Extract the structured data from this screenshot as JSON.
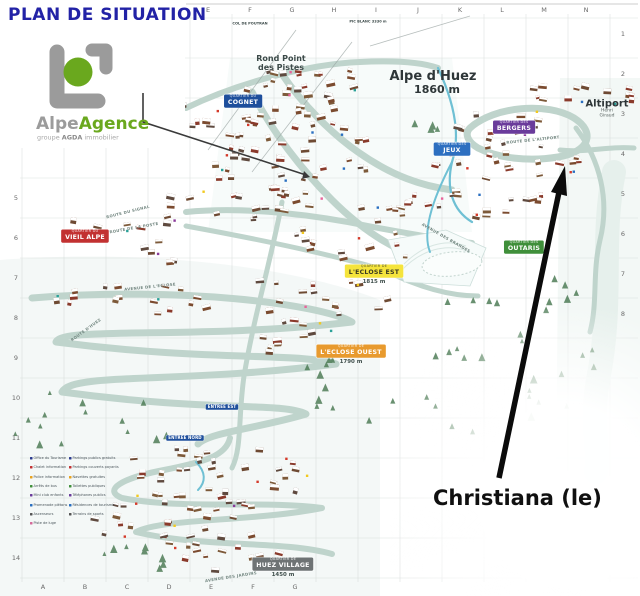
{
  "page": {
    "title": "PLAN DE SITUATION"
  },
  "logo": {
    "name_grey": "Alpe",
    "name_green": "Agence",
    "sub_prefix": "groupe",
    "sub_bold": "AGDA",
    "sub_suffix": "immobilier",
    "green": "#6aa81e",
    "grey": "#9b9b9b"
  },
  "callout": {
    "label": "Christiana (le)"
  },
  "map": {
    "summit_labels": [
      {
        "id": "rond-point-des-pistes",
        "text": "Rond Point\ndes Pistes",
        "x": 281,
        "y": 64,
        "size": 8,
        "weight": 700,
        "color": "#3c4a49"
      },
      {
        "id": "alpe-dhuez",
        "text": "Alpe d'Huez",
        "x": 433,
        "y": 77,
        "size": 13,
        "weight": 700,
        "color": "#2e3638"
      },
      {
        "id": "alpe-dhuez-altitude",
        "text": "1860 m",
        "x": 437,
        "y": 90,
        "size": 11,
        "weight": 700,
        "color": "#2e3638"
      },
      {
        "id": "altiport",
        "text": "Altiport",
        "x": 607,
        "y": 104,
        "size": 10,
        "weight": 700,
        "color": "#2e3638"
      },
      {
        "id": "altiport-sub",
        "text": "Henri Giraud",
        "x": 607,
        "y": 113,
        "size": 4.5,
        "weight": 400,
        "color": "#5a6462"
      },
      {
        "id": "pic-blanc",
        "text": "PIC BLANC 3330 m",
        "x": 368,
        "y": 22,
        "size": 3.6,
        "weight": 700,
        "color": "#3c4a49"
      },
      {
        "id": "col-de-poutran",
        "text": "COL DE POUTRAN",
        "x": 250,
        "y": 24,
        "size": 3.6,
        "weight": 700,
        "color": "#3c4a49"
      }
    ],
    "district_badges": [
      {
        "id": "cognet",
        "small": "QUARTIER DU",
        "main": "COGNET",
        "x": 243,
        "y": 101,
        "bg": "#1e4f9c",
        "fg": "#ffffff"
      },
      {
        "id": "bergers",
        "small": "QUARTIER DES",
        "main": "BERGERS",
        "x": 514,
        "y": 127,
        "bg": "#6a3b9b",
        "fg": "#ffffff"
      },
      {
        "id": "jeux",
        "small": "QUARTIER DES",
        "main": "JEUX",
        "x": 452,
        "y": 149,
        "bg": "#2d6fc0",
        "fg": "#ffffff"
      },
      {
        "id": "vieil-alpe",
        "small": "QUARTIER DU",
        "main": "VIEIL ALPE",
        "x": 85,
        "y": 236,
        "bg": "#c23131",
        "fg": "#ffffff"
      },
      {
        "id": "eclose-est",
        "small": "QUARTIER DE",
        "main": "L'ECLOSE EST",
        "sub": "1815 m",
        "x": 374,
        "y": 271,
        "bg": "#f5e43c",
        "fg": "#3a3a22"
      },
      {
        "id": "eclose-ouest",
        "small": "QUARTIER DE",
        "main": "L'ECLOSE OUEST",
        "sub": "1790 m",
        "x": 351,
        "y": 351,
        "bg": "#e89a2e",
        "fg": "#ffffff"
      },
      {
        "id": "outaris",
        "small": "QUARTIER DES",
        "main": "OUTARIS",
        "x": 524,
        "y": 247,
        "bg": "#3f8f3a",
        "fg": "#ffffff"
      },
      {
        "id": "huez-village",
        "small": "QUARTIER DE",
        "main": "HUEZ VILLAGE",
        "sub": "1450 m",
        "x": 283,
        "y": 564,
        "bg": "#6e7374",
        "fg": "#ffffff"
      },
      {
        "id": "entree-est",
        "main": "ENTREE EST",
        "x": 222,
        "y": 407,
        "bg": "#1e4f9c",
        "fg": "#ffffff",
        "tiny": true
      },
      {
        "id": "entree-nord",
        "main": "ENTREE NORD",
        "x": 185,
        "y": 438,
        "bg": "#1e4f9c",
        "fg": "#ffffff",
        "tiny": true
      }
    ],
    "road_labels": [
      {
        "text": "ROUTE DU SIGNAL",
        "x": 128,
        "y": 212,
        "angle": -14
      },
      {
        "text": "ROUTE DE LA POSTE",
        "x": 134,
        "y": 228,
        "angle": -10
      },
      {
        "text": "AVENUE DE L'ECLOSE",
        "x": 150,
        "y": 287,
        "angle": -6
      },
      {
        "text": "ROUTE D'HUEZ",
        "x": 86,
        "y": 330,
        "angle": -36
      },
      {
        "text": "AVENUE DES JARDINS",
        "x": 231,
        "y": 577,
        "angle": -9
      },
      {
        "text": "AVENUE DES BRANDES",
        "x": 446,
        "y": 238,
        "angle": 30
      },
      {
        "text": "ROUTE DE L'ALTIPORT",
        "x": 533,
        "y": 140,
        "angle": -6
      }
    ],
    "grid": {
      "top_letters": [
        "E",
        "F",
        "G",
        "H",
        "I",
        "J",
        "K",
        "L",
        "M",
        "N"
      ],
      "bottom_letters": [
        "A",
        "B",
        "C",
        "D",
        "E",
        "F",
        "G"
      ],
      "left_numbers": [
        "5",
        "6",
        "7",
        "8",
        "9",
        "10",
        "11",
        "12",
        "13",
        "14"
      ],
      "right_numbers": [
        "1",
        "2",
        "3",
        "4",
        "5",
        "6",
        "7",
        "8"
      ]
    },
    "legend": {
      "col1": [
        "Office du Tourisme",
        "Chalet information",
        "Police information",
        "Arrêts de bus",
        "Mini club enfants",
        "Promenade piétons",
        "Ascenseurs",
        "Piste de luge"
      ],
      "col2": [
        "Parkings publics gratuits",
        "Parkings couverts payants",
        "Navettes gratuites",
        "Toilettes publiques",
        "Téléphones publics",
        "Résidences de tourisme",
        "Terrains de sports"
      ]
    }
  }
}
